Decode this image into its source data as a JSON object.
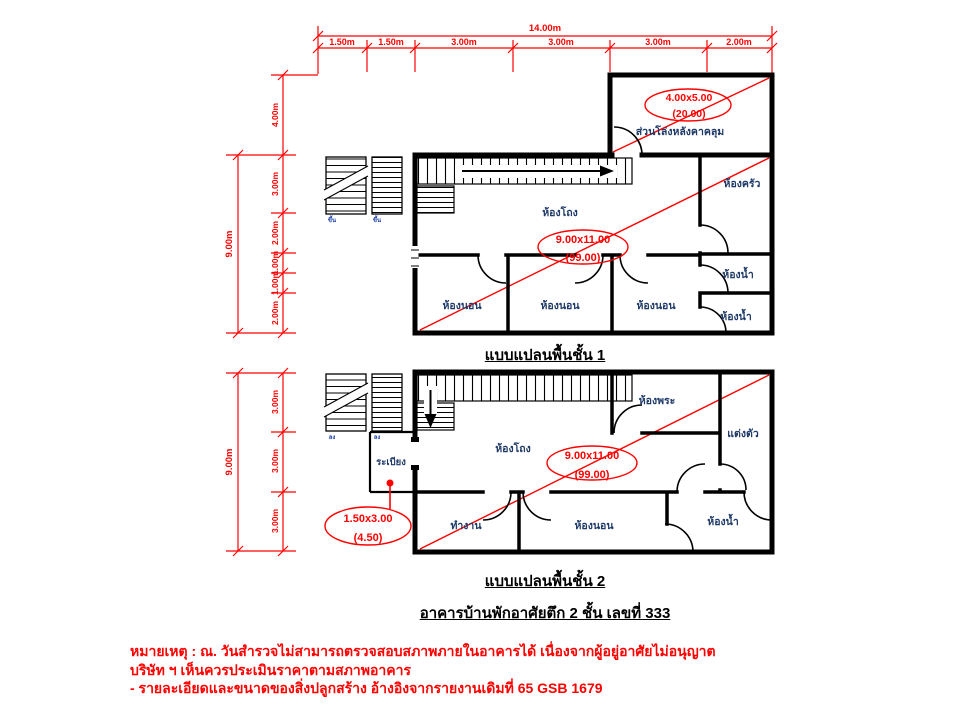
{
  "drawing": {
    "colors": {
      "dimension_red": "#ff0000",
      "wall_black": "#000000",
      "room_label_navy": "#1f3a68",
      "annotation_red": "#ff0000",
      "notes_red": "#ff0000",
      "stair_label_blue": "#2244aa"
    },
    "top_dim": {
      "total": "14.00m",
      "segments": [
        "1.50m",
        "1.50m",
        "3.00m",
        "3.00m",
        "3.00m",
        "2.00m"
      ]
    },
    "floor1": {
      "caption": "แบบแปลนพื้นชั้น 1",
      "dim_total": "9.00m",
      "dim_segments": [
        "4.00m",
        "3.00m",
        "2.00m",
        "1.00m",
        "1.00m",
        "2.00m"
      ],
      "annex": {
        "label": "ส่วนโล่งหลังคาคลุม",
        "size": "4.00x5.00",
        "area": "(20.00)"
      },
      "main": {
        "size": "9.00x11.00",
        "area": "(99.00)"
      },
      "rooms": {
        "hall": "ห้องโถง",
        "kitchen": "ห้องครัว",
        "bath1": "ห้องน้ำ",
        "bath2": "ห้องน้ำ",
        "bed1": "ห้องนอน",
        "bed2": "ห้องนอน",
        "bed3": "ห้องนอน"
      },
      "stair_label": "ขึ้น"
    },
    "floor2": {
      "caption": "แบบแปลนพื้นชั้น 2",
      "dim_total": "9.00m",
      "dim_segments": [
        "3.00m",
        "3.00m",
        "3.00m"
      ],
      "balcony": {
        "label": "ระเบียง",
        "size": "1.50x3.00",
        "area": "(4.50)"
      },
      "main": {
        "size": "9.00x11.00",
        "area": "(99.00)"
      },
      "rooms": {
        "hall": "ห้องโถง",
        "prayer": "ห้องพระ",
        "dressing": "แต่งตัว",
        "work": "ทำงาน",
        "bed": "ห้องนอน",
        "bath": "ห้องน้ำ"
      },
      "stair_label": "ลง"
    },
    "title": "อาคารบ้านพักอาศัยตึก 2 ชั้น เลขที่ 333",
    "notes": [
      "หมายเหตุ : ณ. วันสำรวจไม่สามารถตรวจสอบสภาพภายในอาคารได้ เนื่องจากผู้อยู่อาศัยไม่อนุญาต",
      "บริษัท ฯ เห็นควรประเมินราคาตามสภาพอาคาร",
      "- รายละเอียดและขนาดของสิ่งปลูกสร้าง อ้างอิงจากรายงานเดิมที่ 65 GSB 1679"
    ]
  }
}
